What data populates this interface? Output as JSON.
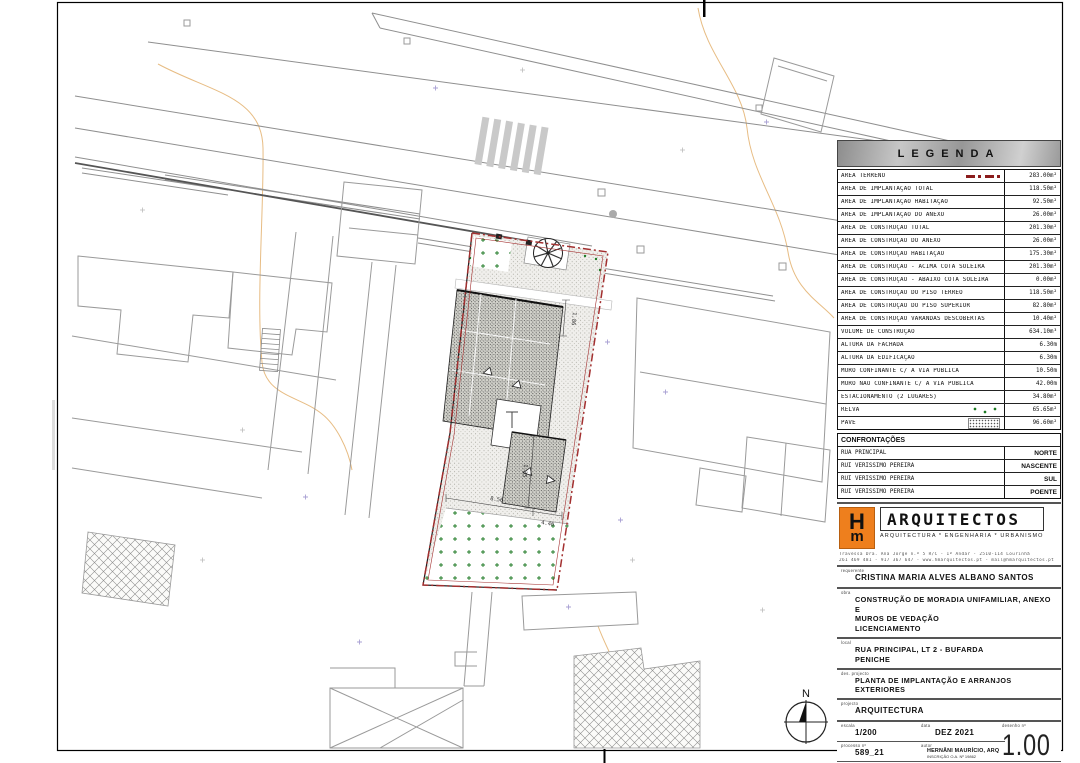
{
  "legend": {
    "title": "LEGENDA",
    "rows": [
      {
        "label": "ÁREA TERRENO",
        "symbol": "terrain",
        "value": "283.00m²"
      },
      {
        "label": "ÁREA DE IMPLANTAÇÃO TOTAL",
        "value": "118.50m²"
      },
      {
        "label": "ÁREA DE IMPLANTAÇÃO HABITAÇÃO",
        "value": "92.50m²"
      },
      {
        "label": "ÁREA DE IMPLANTAÇÃO DO ANEXO",
        "value": "26.00m²"
      },
      {
        "label": "ÁREA DE CONSTRUÇÃO TOTAL",
        "value": "201.30m²"
      },
      {
        "label": "ÁREA DE CONSTRUÇÃO DO ANEXO",
        "value": "26.00m²"
      },
      {
        "label": "ÁREA DE CONSTRUÇÃO HABITAÇÃO",
        "value": "175.30m²"
      },
      {
        "label": "ÁREA DE CONSTRUÇÃO - ACIMA COTA SOLEIRA",
        "value": "201.30m²"
      },
      {
        "label": "ÁREA DE CONSTRUÇÃO - ABAIXO COTA SOLEIRA",
        "value": "0.00m²"
      },
      {
        "label": "ÁREA DE CONSTRUÇÃO DO PISO TÉRREO",
        "value": "118.50m²"
      },
      {
        "label": "ÁREA DE CONSTRUÇÃO DO PISO SUPERIOR",
        "value": "82.80m²"
      },
      {
        "label": "ÁREA DE CONSTRUÇÃO VARANDAS DESCOBERTAS",
        "value": "10.40m²"
      },
      {
        "label": "VOLUME DE CONSTRUÇÃO",
        "value": "634.10m³"
      },
      {
        "label": "ALTURA DA FACHADA",
        "value": "6.30m"
      },
      {
        "label": "ALTURA DA EDIFICAÇÃO",
        "value": "6.30m"
      },
      {
        "label": "MURO CONFINANTE C/ A VIA PÚBLICA",
        "value": "10.50m"
      },
      {
        "label": "MURO NÃO CONFINANTE C/ A VIA PÚBLICA",
        "value": "42.00m"
      },
      {
        "label": "ESTACIONAMENTO (2 LUGARES)",
        "value": "34.80m²"
      },
      {
        "label": "RELVA",
        "symbol": "grass",
        "value": "65.65m²"
      },
      {
        "label": "PAVÊ",
        "symbol": "pave",
        "value": "96.60m²"
      }
    ]
  },
  "confrontacoes": {
    "title": "CONFRONTAÇÕES",
    "rows": [
      {
        "name": "RUA PRINCIPAL",
        "dir": "NORTE"
      },
      {
        "name": "RUI VERISSIMO PEREIRA",
        "dir": "NASCENTE"
      },
      {
        "name": "RUI VERISSIMO PEREIRA",
        "dir": "SUL"
      },
      {
        "name": "RUI VERISSIMO PEREIRA",
        "dir": "POENTE"
      }
    ]
  },
  "firm": {
    "logo_h": "H",
    "logo_m": "m",
    "name": "ARQUITECTOS",
    "tagline": "ARQUITECTURA * ENGENHARIA * URBANISMO",
    "address1": "Travessa Dra. Ana Jorge n.º 5 R/C - 1º Andar - 2510-114 Lourinhã",
    "address2": "261 469 481 - 917 367 647 - www.hmarquitectos.pt - mail@hmarquitectos.pt"
  },
  "titleblock": {
    "requerente_label": "requerente",
    "requerente": "CRISTINA MARIA ALVES ALBANO SANTOS",
    "obra_label": "obra",
    "obra_line1": "CONSTRUÇÃO DE MORADIA UNIFAMILIAR, ANEXO E",
    "obra_line2": "MUROS DE VEDAÇÃO",
    "obra_line3": "LICENCIAMENTO",
    "local_label": "local",
    "local_line1": "RUA PRINCIPAL, LT 2 - BUFARDA",
    "local_line2": "PENICHE",
    "des_label": "des. projecto",
    "des": "PLANTA DE IMPLANTAÇÃO E ARRANJOS EXTERIORES",
    "projecto_label": "projecto",
    "projecto": "ARQUITECTURA",
    "escala_label": "escala",
    "escala": "1/200",
    "data_label": "data",
    "data": "DEZ 2021",
    "desenho_label": "desenho nº",
    "desenho": "1.00",
    "processo_label": "processo nº",
    "processo": "589_21",
    "autor_label": "autor",
    "autor": "HERNÂNI MAURÍCIO, ARQ",
    "autor_sub": "INSCRIÇÃO O.A. Nº 19862",
    "substitui_label": "substitui",
    "desenhado_label": "desenhado por"
  },
  "plan": {
    "north": "N",
    "dims": {
      "d1": "8.56",
      "d2": "4.46",
      "d3": "1.86",
      "d4": "1.35"
    }
  }
}
